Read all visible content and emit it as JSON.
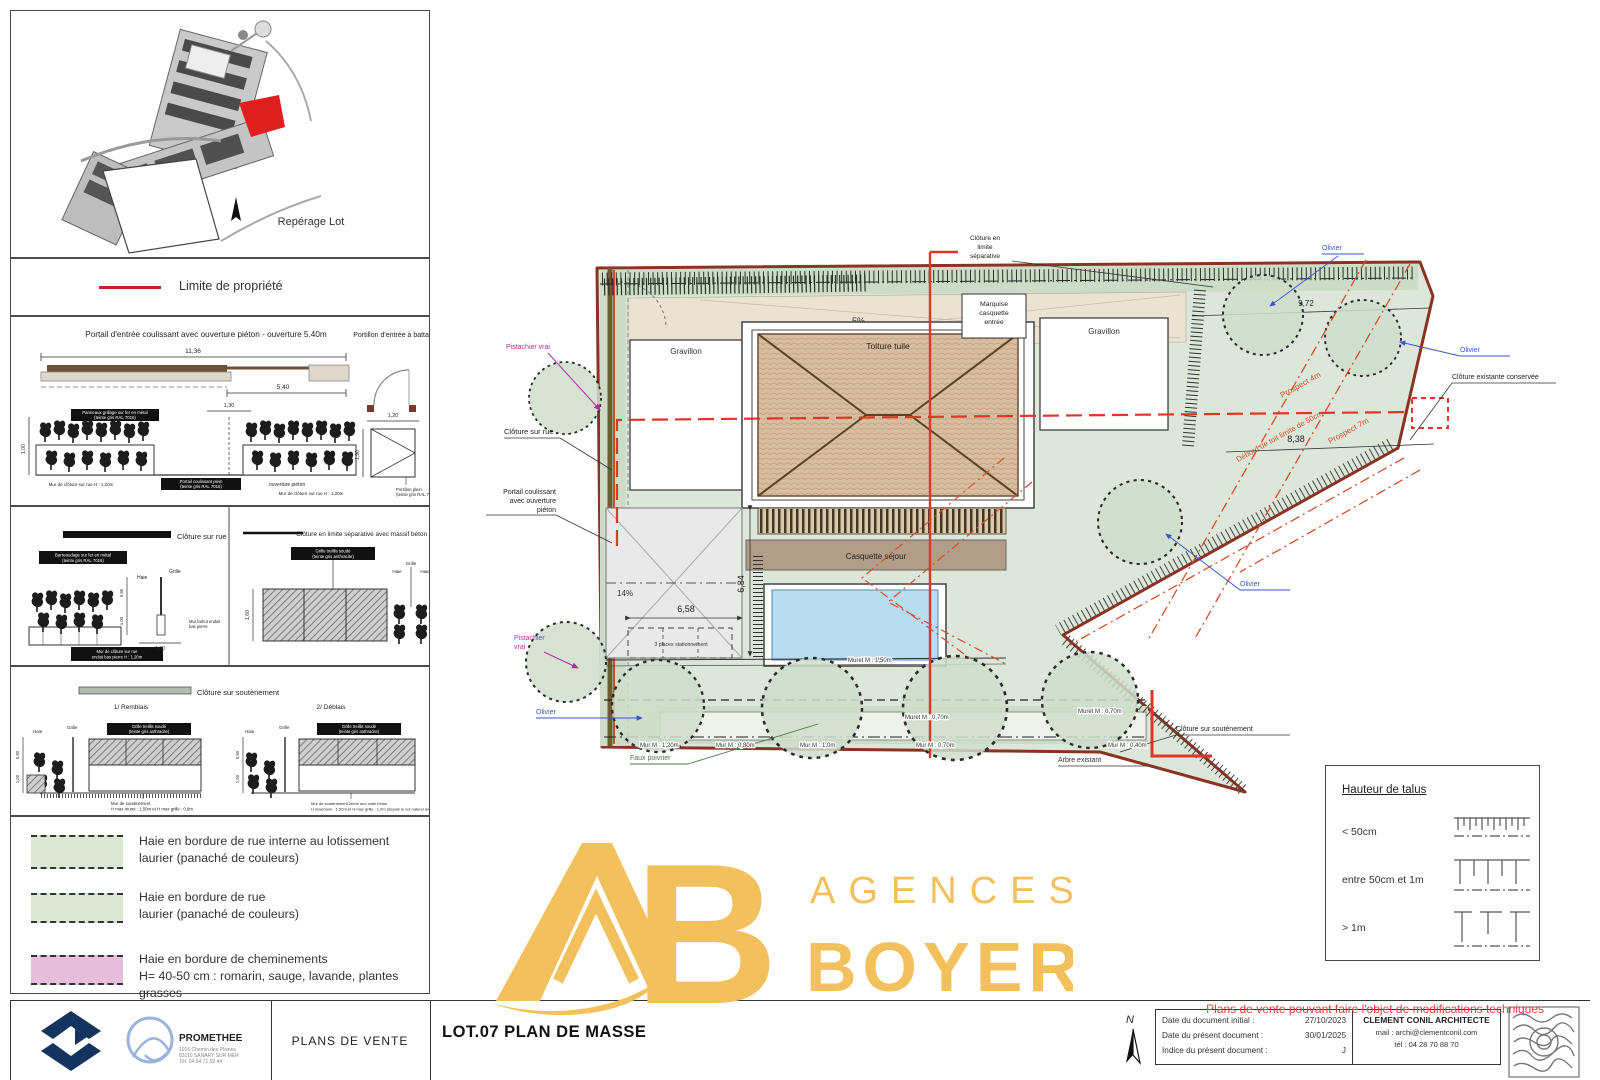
{
  "colors": {
    "gold": "#F3C05E",
    "red_limit": "#E23527",
    "boundary_red": "#8A3323",
    "sage": "#DDE7D9",
    "hedge_green": "#CDDCC9",
    "legend_pink": "#E6BEDC",
    "pool_blue": "#BADCF1",
    "roof_tan": "#D8BDA1",
    "blue_label": "#3A55C8",
    "magenta_label": "#B030A0",
    "green_label": "#4A7A40",
    "navy_logo": "#14335E"
  },
  "north_letter": "N",
  "notice": "Plans de vente pouvant faire l'objet de modifications techniques",
  "watermark": {
    "ab_b": "B",
    "agences": "AGENCES",
    "boyer": "BOYER"
  },
  "left_panel": {
    "reperage_label": "Repérage Lot",
    "limite_label": "Limite de propriété",
    "portail": {
      "title": "Portail d'entrée coulissant avec ouverture piéton - ouverture 5.40m",
      "dim_total": "11,36",
      "dim_open": "5,40",
      "dim_pieton": "1,30",
      "dim_h": "1,00",
      "note_grille_l1": "Panneaux grillage sur fer en métal",
      "note_grille_l2": "(teinte gris RAL 7016)",
      "note_portail_l1": "Portail coulissant plein",
      "note_portail_l2": "(teinte gris RAL 7016)",
      "note_ouverture": "ouverture piéton",
      "note_mur": "Mur de clôture sur rue H : 1,20m"
    },
    "portillon": {
      "title": "Portillon d'entrée à battant",
      "dim_w": "1,20",
      "dim_h": "1,90",
      "note_l1": "Portillon plein",
      "note_l2": "(teinte gris RAL 7016)"
    },
    "cloture_rue": {
      "legend": "Clôture sur rue",
      "note_top_l1": "Barreaudage sur fer en métal",
      "note_top_l2": "(teinte gris RAL 7016)",
      "note_bottom_l1": "Mur de clôture sur rue",
      "note_bottom_l2": "enduit bas pierre H : 1,20m",
      "grille": "Grille",
      "haie": "Haie",
      "dim_h1": "0,90",
      "dim_h2": "1,00",
      "dim_w": "1,00",
      "note_right_l1": "Mur bahut enduit",
      "note_right_l2": "bas pierre"
    },
    "cloture_sep": {
      "legend": "Clôture en limite séparative avec massif béton",
      "note_l1": "Grille treillis soudé",
      "note_l2": "(teinte gris anthracite)",
      "grille": "Grille",
      "haie": "Haie",
      "dim_h": "1,60"
    },
    "soutenement": {
      "legend": "Clôture sur soutènement",
      "sub1": "1/ Remblais",
      "sub2": "2/ Déblais",
      "note_l1": "Grille treillis soudé",
      "note_l2": "(teinte gris anthracite)",
      "grille": "Grille",
      "haie": "Haie",
      "dim_h1": "0,90",
      "dim_h2": "1,00",
      "note_mur1_l1": "Mur de soutènement",
      "note_mur1_l2": "H max muret : 1,50m et H max grille : 0,9m",
      "note_mur2_l1": "Mur de soutènement 2ème mur voile béton",
      "note_mur2_l2": "H maximum : 1,50m et H max grille : 1,0m (depuis le sol naturel aval)"
    },
    "haies": [
      {
        "label1": "Haie en bordure de rue interne au lotissement",
        "label2": "laurier (panaché de couleurs)",
        "color": "#dbe7d3"
      },
      {
        "label1": "Haie en bordure de rue",
        "label2": "laurier (panaché de couleurs)",
        "color": "#dbe7d3"
      },
      {
        "label1": "Haie en bordure de cheminements",
        "label2": "H= 40-50 cm : romarin, sauge, lavande, plantes grasses",
        "color": "#e6bedc"
      }
    ]
  },
  "plan": {
    "labels": {
      "cloture_sep_l1": "Clôture en",
      "cloture_sep_l2": "limite",
      "cloture_sep_l3": "séparative",
      "slope_top": "5%",
      "slope_drive": "14%",
      "marquise_l1": "Marquise",
      "marquise_l2": "casquette",
      "marquise_l3": "entrée",
      "gravillon": "Gravillon",
      "toiture": "Toiture tuile",
      "casquette_sejour": "Casquette séjour",
      "pistachier": "Pistachier vrai",
      "pistachier_l1": "Pistachier",
      "pistachier_l2": "vrai",
      "cloture_rue": "Clôture sur rue",
      "portail_l1": "Portail coulissant",
      "portail_l2": "avec ouverture",
      "portail_l3": "piéton",
      "olivier": "Olivier",
      "cloture_existante": "Clôture existante conservée",
      "cloture_soutenement": "Clôture sur soutènement",
      "faux_poivrier": "Faux poivrier",
      "arbre_existant": "Arbre existant",
      "prospect4": "Prospect 4m",
      "prospect7": "Prospect 7m",
      "debord": "Débord de toit limite de 50cm",
      "parking": "3 places stationnement"
    },
    "dims": {
      "d1": "8,38",
      "d2": "9,72",
      "d3": "6,58",
      "d4": "6,84"
    },
    "murs": [
      "Muret M : 1,50m",
      "Muret M : 0,70m",
      "Mur M : 1,20m",
      "Mur M : 0,80m",
      "Mur M : 1,0m",
      "Mur M : 0,70m",
      "Mur M : 0,40m"
    ]
  },
  "talus": {
    "title": "Hauteur de talus",
    "rows": [
      "< 50cm",
      "entre 50cm et 1m",
      "> 1m"
    ]
  },
  "titleblock": {
    "promethee": "PROMETHEE",
    "addr1": "1016 Chemin des Plaines",
    "addr2": "83110 SANARY SUR MER",
    "addr3": "Tél. 04 94 71 58 44",
    "plans_de_vente": "PLANS DE VENTE",
    "title": "LOT.07 PLAN DE MASSE",
    "date_initial_label": "Date du document initial :",
    "date_initial": "27/10/2023",
    "date_present_label": "Date du présent document :",
    "date_present": "30/01/2025",
    "indice_label": "Indice du présent document :",
    "indice": "J",
    "architecte": "CLEMENT CONIL ARCHITECTE",
    "mail": "mail :  archi@clementconil.com",
    "tel": "tél :   04 28 70 88 70"
  }
}
